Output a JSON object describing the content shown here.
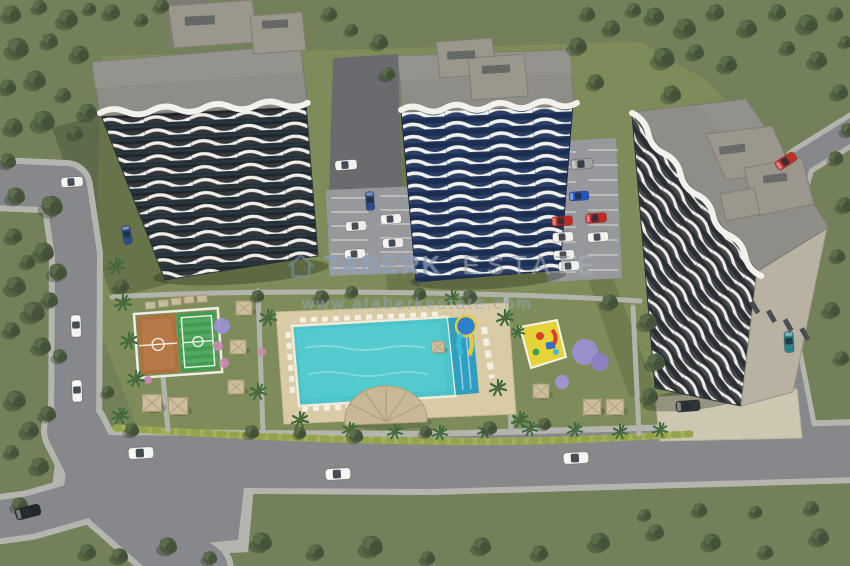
{
  "watermark": {
    "logo": "house-outline",
    "brand": "TABERK",
    "suffix": "ESTATE",
    "url": "www.ataberkestate.com"
  },
  "palette": {
    "grassOuter": "#73815A",
    "grassInner": "#7E8C5A",
    "roadAsphalt": "#87888B",
    "roadDark": "#6A6B6E",
    "sidewalk": "#B4B5AF",
    "parkingGray": "#97989C",
    "plazaBeige": "#CDC7B2",
    "roofGray": "#8F8D88",
    "facadeDark": "#33383E",
    "facadeBlue": "#2A3E66",
    "balconyWhite": "#F2F1EC",
    "poolWater": "#4BC5C9",
    "poolLane": "#2F9EC0",
    "deckSand": "#D8CBA6",
    "courtOrange": "#B0713F",
    "courtGreen": "#3F9E4F",
    "hedgeGreen": "#A3B158",
    "playgroundYellow": "#E8D23A",
    "domeTan": "#C8B895",
    "watermarkBlue": "#7E97B7"
  },
  "scene": {
    "description_objects": [
      "left-tower",
      "center-tower",
      "right-tower",
      "swimming-pool",
      "water-slide",
      "pool-dome-building",
      "basketball-court",
      "mini-football-pitch",
      "kids-playground",
      "gazebos",
      "parking-lots",
      "roads",
      "cars",
      "trees"
    ],
    "trees": [
      [
        12,
        14,
        1
      ],
      [
        40,
        7,
        0.8
      ],
      [
        68,
        19,
        1.1
      ],
      [
        90,
        9,
        0.7
      ],
      [
        18,
        48,
        1.2
      ],
      [
        50,
        41,
        0.9
      ],
      [
        80,
        54,
        1
      ],
      [
        8,
        87,
        0.9
      ],
      [
        36,
        80,
        1.1
      ],
      [
        64,
        95,
        0.8
      ],
      [
        14,
        127,
        1
      ],
      [
        44,
        121,
        1.2
      ],
      [
        76,
        133,
        0.8
      ],
      [
        8,
        161,
        0.9
      ],
      [
        88,
        112,
        1
      ],
      [
        112,
        12,
        0.9
      ],
      [
        142,
        20,
        0.7
      ],
      [
        162,
        6,
        0.8
      ],
      [
        380,
        42,
        0.9
      ],
      [
        388,
        74,
        0.8
      ],
      [
        330,
        14,
        0.8
      ],
      [
        352,
        30,
        0.7
      ],
      [
        578,
        46,
        1
      ],
      [
        596,
        82,
        0.9
      ],
      [
        588,
        14,
        0.8
      ],
      [
        612,
        28,
        0.9
      ],
      [
        634,
        10,
        0.8
      ],
      [
        655,
        16,
        1
      ],
      [
        686,
        28,
        1.1
      ],
      [
        716,
        12,
        0.9
      ],
      [
        748,
        28,
        1
      ],
      [
        778,
        12,
        0.9
      ],
      [
        808,
        24,
        1.1
      ],
      [
        836,
        14,
        0.8
      ],
      [
        664,
        58,
        1.2
      ],
      [
        696,
        52,
        0.9
      ],
      [
        728,
        64,
        1
      ],
      [
        788,
        48,
        0.8
      ],
      [
        818,
        60,
        1
      ],
      [
        846,
        42,
        0.7
      ],
      [
        672,
        94,
        1
      ],
      [
        840,
        92,
        0.9
      ],
      [
        848,
        130,
        0.8
      ],
      [
        836,
        158,
        0.8
      ],
      [
        845,
        205,
        0.9
      ],
      [
        838,
        256,
        0.8
      ],
      [
        832,
        310,
        0.9
      ],
      [
        842,
        358,
        0.8
      ],
      [
        16,
        196,
        1
      ],
      [
        52,
        206,
        1.2
      ],
      [
        14,
        236,
        0.9
      ],
      [
        44,
        252,
        1.1
      ],
      [
        28,
        262,
        0.8
      ],
      [
        58,
        272,
        1
      ],
      [
        16,
        286,
        1.1
      ],
      [
        50,
        300,
        0.9
      ],
      [
        34,
        312,
        1.2
      ],
      [
        12,
        330,
        0.9
      ],
      [
        42,
        346,
        1
      ],
      [
        60,
        356,
        0.8
      ],
      [
        16,
        400,
        1.1
      ],
      [
        48,
        414,
        0.9
      ],
      [
        30,
        430,
        1
      ],
      [
        12,
        452,
        0.8
      ],
      [
        40,
        466,
        1
      ],
      [
        20,
        505,
        0.9
      ],
      [
        120,
        556,
        0.9
      ],
      [
        168,
        546,
        1
      ],
      [
        210,
        558,
        0.8
      ],
      [
        262,
        542,
        1.1
      ],
      [
        316,
        552,
        0.9
      ],
      [
        372,
        546,
        1.2
      ],
      [
        428,
        558,
        0.8
      ],
      [
        482,
        546,
        1
      ],
      [
        540,
        553,
        0.9
      ],
      [
        600,
        542,
        1.1
      ],
      [
        656,
        532,
        0.9
      ],
      [
        712,
        542,
        1
      ],
      [
        766,
        552,
        0.8
      ],
      [
        820,
        537,
        1
      ],
      [
        700,
        510,
        0.8
      ],
      [
        756,
        512,
        0.7
      ],
      [
        812,
        508,
        0.8
      ],
      [
        645,
        515,
        0.7
      ],
      [
        88,
        552,
        0.9
      ],
      [
        122,
        286,
        0.8
      ],
      [
        258,
        296,
        0.7
      ],
      [
        322,
        297,
        0.8
      ],
      [
        352,
        292,
        0.7
      ],
      [
        420,
        294,
        0.7
      ],
      [
        470,
        297,
        0.8
      ],
      [
        610,
        302,
        0.9
      ],
      [
        648,
        322,
        1
      ],
      [
        656,
        362,
        1
      ],
      [
        650,
        396,
        0.9
      ],
      [
        252,
        432,
        0.8
      ],
      [
        300,
        433,
        0.7
      ],
      [
        356,
        436,
        0.8
      ],
      [
        426,
        432,
        0.7
      ],
      [
        490,
        428,
        0.8
      ],
      [
        545,
        424,
        0.7
      ],
      [
        132,
        430,
        0.8
      ],
      [
        108,
        392,
        0.7
      ]
    ],
    "palms": [
      [
        116,
        266,
        1
      ],
      [
        123,
        303,
        1
      ],
      [
        129,
        341,
        1
      ],
      [
        136,
        379,
        1
      ],
      [
        120,
        416,
        1
      ],
      [
        268,
        318,
        1
      ],
      [
        258,
        392,
        1
      ],
      [
        300,
        420,
        1
      ],
      [
        452,
        298,
        0.9
      ],
      [
        505,
        318,
        1
      ],
      [
        498,
        388,
        1
      ],
      [
        520,
        420,
        1
      ],
      [
        350,
        430,
        0.9
      ],
      [
        395,
        432,
        0.9
      ],
      [
        440,
        433,
        0.9
      ],
      [
        485,
        431,
        0.9
      ],
      [
        530,
        429,
        0.9
      ],
      [
        575,
        430,
        0.9
      ],
      [
        620,
        432,
        0.9
      ],
      [
        660,
        430,
        0.9
      ],
      [
        518,
        332,
        0.8
      ]
    ],
    "gazebos": [
      [
        244,
        308,
        1
      ],
      [
        238,
        347,
        1
      ],
      [
        236,
        387,
        1
      ],
      [
        152,
        403,
        1.2
      ],
      [
        178,
        406,
        1.2
      ],
      [
        541,
        391,
        1
      ],
      [
        592,
        407,
        1.1
      ],
      [
        615,
        407,
        1.1
      ],
      [
        438,
        347,
        0.8
      ]
    ],
    "flowering_trees": [
      [
        585,
        352,
        13,
        "#9B8FD0"
      ],
      [
        600,
        362,
        9,
        "#8F7FC6"
      ],
      [
        562,
        382,
        7,
        "#A393D6"
      ],
      [
        222,
        326,
        8,
        "#9B8FD0"
      ],
      [
        218,
        346,
        5,
        "#C98BB0"
      ],
      [
        224,
        363,
        5,
        "#C98BB0"
      ],
      [
        148,
        380,
        4,
        "#C98BB0"
      ],
      [
        262,
        352,
        4,
        "#C98BB0"
      ]
    ],
    "cars": [
      [
        72,
        182,
        -4,
        "#F2F2F0",
        1
      ],
      [
        76,
        326,
        88,
        "#F4F4F2",
        1
      ],
      [
        77,
        391,
        88,
        "#F4F4F2",
        1
      ],
      [
        127,
        235,
        80,
        "#2B4C8C",
        0.85
      ],
      [
        28,
        512,
        -14,
        "#23262B",
        1.15
      ],
      [
        141,
        453,
        -3,
        "#F4F4F2",
        1.15
      ],
      [
        338,
        474,
        -3,
        "#F6F6F4",
        1.15
      ],
      [
        576,
        458,
        -3,
        "#F4F4F2",
        1.15
      ],
      [
        786,
        161,
        -33,
        "#C03028",
        1
      ],
      [
        789,
        342,
        87,
        "#2E7F86",
        0.95
      ],
      [
        346,
        165,
        -4,
        "#EFEFED",
        1
      ],
      [
        356,
        226,
        -4,
        "#EDEDEB",
        0.95
      ],
      [
        391,
        219,
        -4,
        "#F0F0EE",
        0.95
      ],
      [
        393,
        243,
        -4,
        "#EDEDEB",
        0.95
      ],
      [
        355,
        254,
        -4,
        "#F0F0EE",
        0.95
      ],
      [
        370,
        201,
        86,
        "#2B4C8C",
        0.85
      ],
      [
        582,
        164,
        -5,
        "#9FA1A3",
        1
      ],
      [
        579,
        196,
        -4,
        "#2455C4",
        0.9
      ],
      [
        562,
        221,
        -4,
        "#C22B22",
        0.95
      ],
      [
        596,
        218,
        -4,
        "#C22B22",
        0.95
      ],
      [
        563,
        237,
        -4,
        "#EFEFED",
        0.95
      ],
      [
        598,
        237,
        -4,
        "#F0F0EE",
        0.95
      ],
      [
        564,
        255,
        -4,
        "#EDEDEB",
        0.95
      ],
      [
        569,
        266,
        -4,
        "#F0F0EE",
        0.95
      ],
      [
        688,
        406,
        -4,
        "#30343A",
        1.1
      ]
    ]
  }
}
